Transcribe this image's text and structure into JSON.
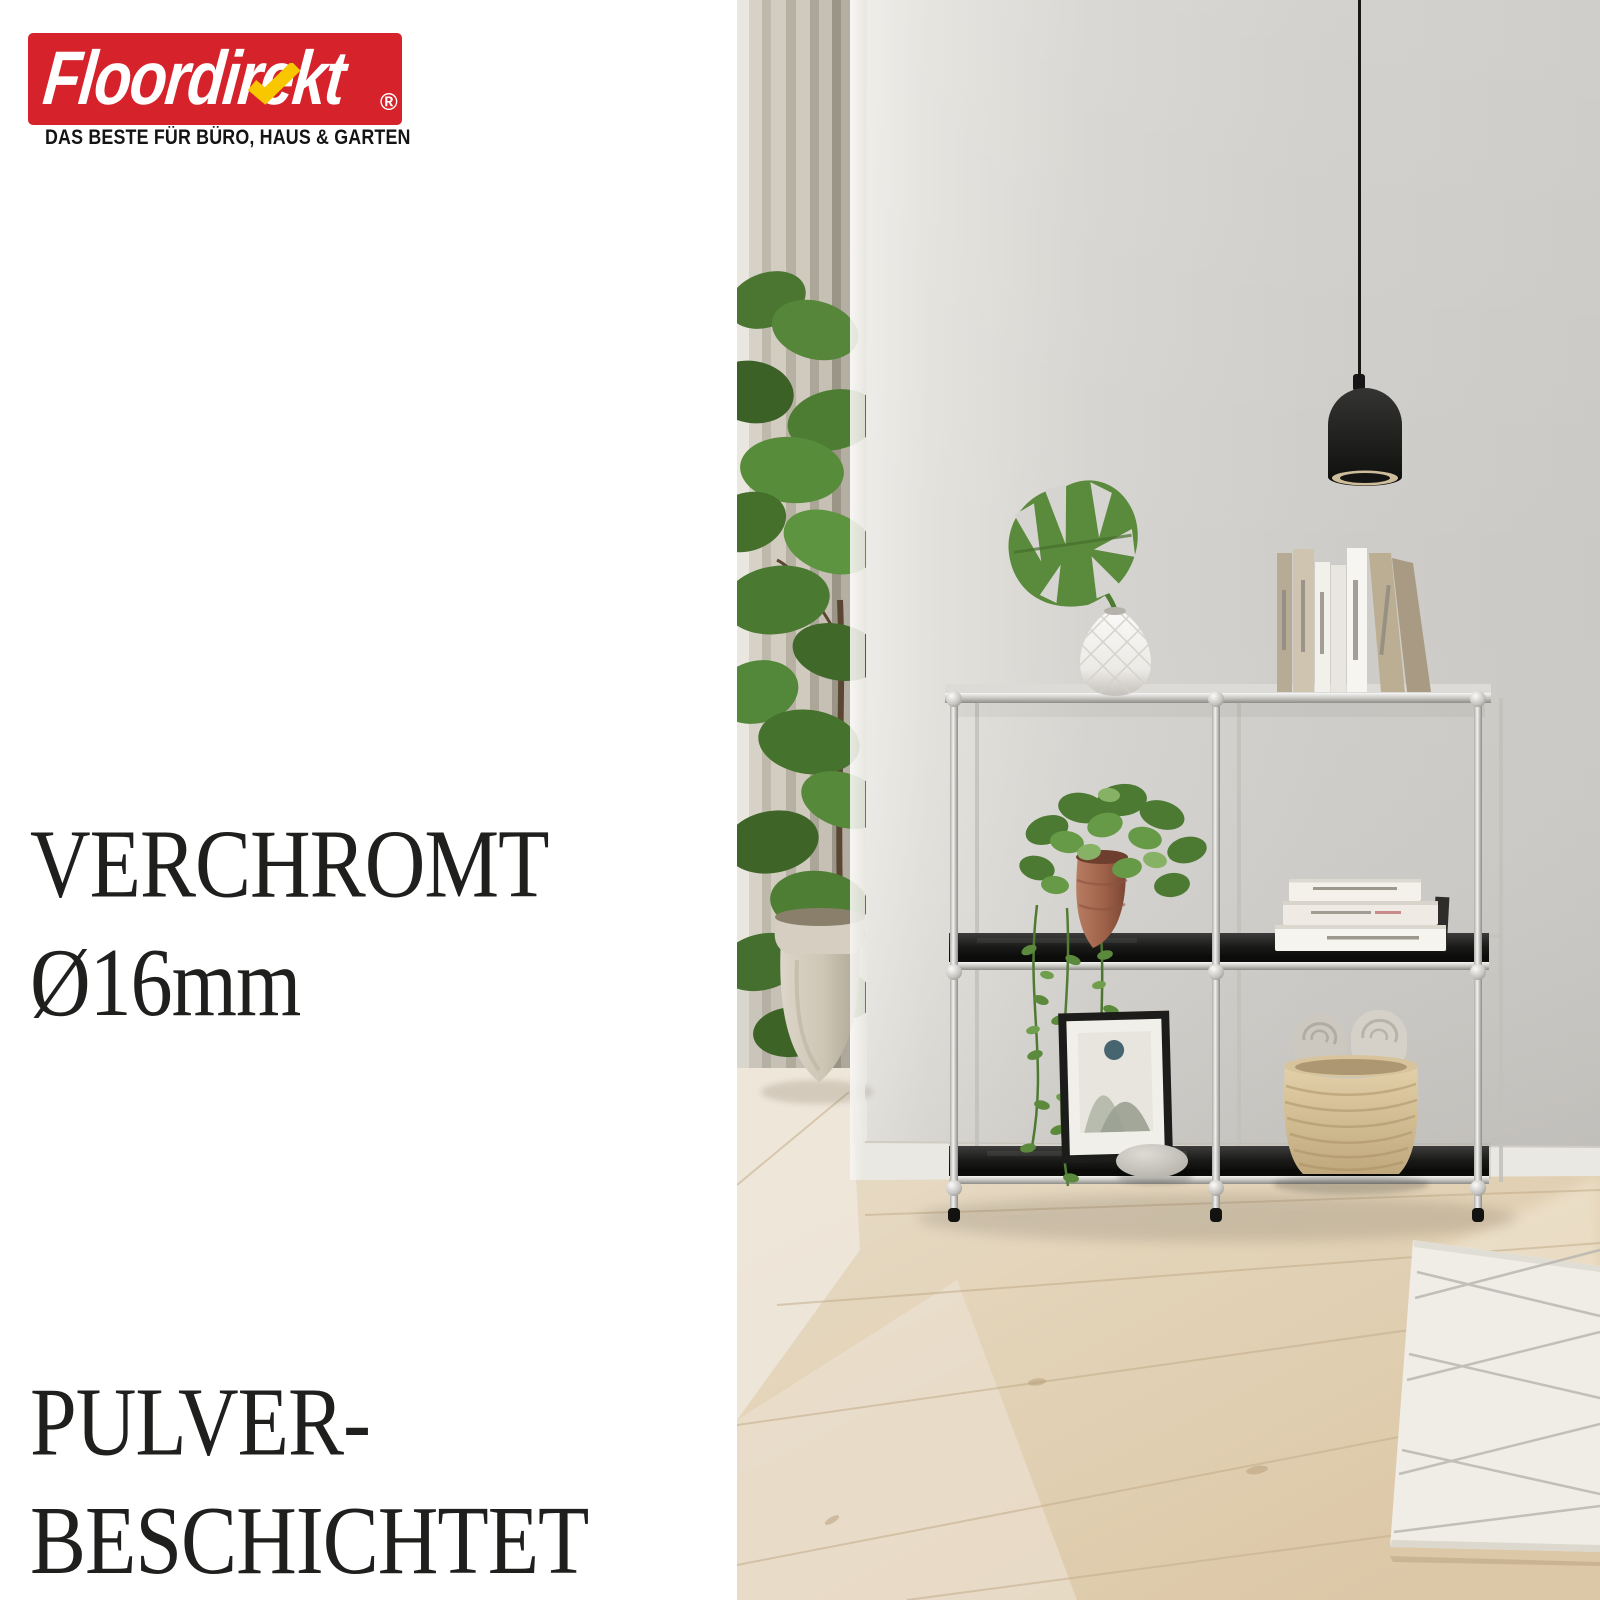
{
  "logo": {
    "brand": "Floordirekt",
    "registered": "®",
    "tagline": "DAS BESTE FÜR BÜRO, HAUS & GARTEN",
    "brand_red": "#d6232b",
    "brand_yellow": "#f8c700"
  },
  "features": [
    {
      "line1": "VERCHROMT",
      "line2": "Ø16mm"
    },
    {
      "line1": "PULVER-",
      "line2": "BESCHICHTET"
    }
  ],
  "headline_color": "#1f1f1e",
  "scene_colors": {
    "wall_gray": "#d2d0cc",
    "curtain_beige": "#c6c0b4",
    "leaf_green": "#5a8a3b",
    "terracotta": "#a5664d",
    "shelf_black": "#141414",
    "chrome": "#c9c7c2",
    "lamp_black": "#1d1d1d",
    "floor_wood": "#e3d3b8",
    "basket_weave": "#d8c49c",
    "rug_cream": "#efede6"
  }
}
